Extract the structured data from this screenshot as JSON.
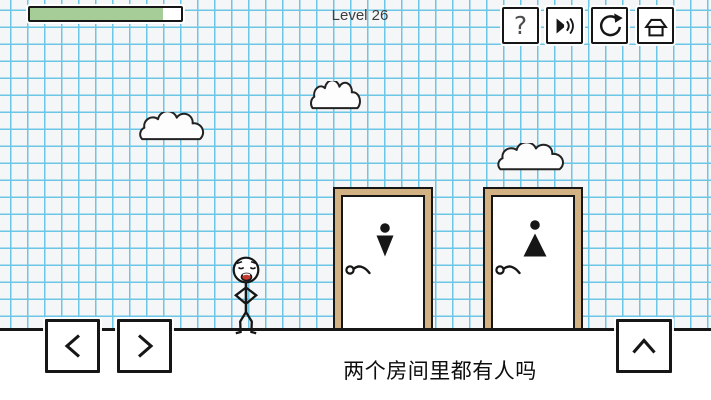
{
  "header": {
    "level_label": "Level 26",
    "progress_percent": 88
  },
  "toolbar": {
    "help_button": {
      "icon": "question-mark",
      "glyph": "?"
    },
    "sound_button": {
      "icon": "speaker"
    },
    "restart_button": {
      "icon": "restart-arrow"
    },
    "home_button": {
      "icon": "home"
    }
  },
  "scene": {
    "clouds_count": 3,
    "doors": [
      {
        "id": "left-door",
        "sign": "person-triangle-down"
      },
      {
        "id": "right-door",
        "sign": "person-triangle-up"
      }
    ],
    "character": "stickman"
  },
  "controls": {
    "move_left": {
      "icon": "chevron-left"
    },
    "move_right": {
      "icon": "chevron-right"
    },
    "jump": {
      "icon": "chevron-up"
    }
  },
  "question": {
    "text": "两个房间里都有人吗"
  },
  "colors": {
    "grid_line": "#6cc6e5",
    "paper": "#f4f6f8",
    "door_frame": "#d2b183",
    "progress_fill": "#a6cc97",
    "ink": "#161616",
    "mouth": "#c43a2e"
  }
}
